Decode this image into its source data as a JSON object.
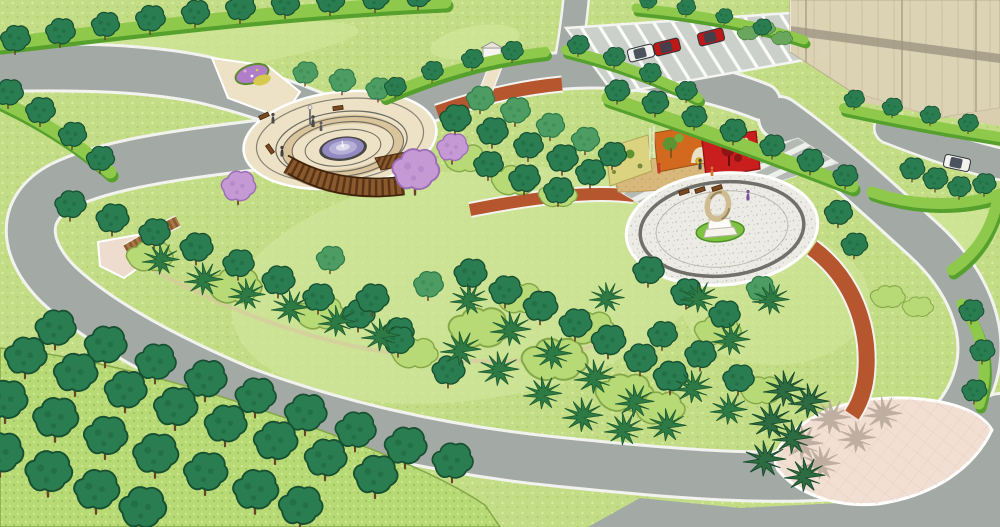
{
  "meta": {
    "title": "Park landscape design - aerial 3D rendering",
    "description": "SketchUp-style bird's-eye rendering of a public park with fountain plaza, pergola, sculpture plaza with colored art walls, leaf-shaped plaza, ring roads, street trees, parking lot with cars and a residential tower.",
    "view": "aerial isometric",
    "width": 1000,
    "height": 527
  },
  "features": {
    "fountain_plaza": "Circular fountain plaza with pergola",
    "sculpture_plaza": "Sculpture plaza with art walls",
    "leaf_plaza": "Leaf-shaped paved plaza",
    "parking_lot": "Roadside parking",
    "building": "Residential tower",
    "ring_road": "Perimeter ring road"
  },
  "palette": {
    "lawn": "#c3dc86",
    "lawnBright": "#cfe699",
    "road": "#a3aaa6",
    "roadEdge": "#f2f3ef",
    "hedge": "#8fc94c",
    "hedgeDark": "#56a02e",
    "treeDark": "#2a7d50",
    "treeDarkOutline": "#174f31",
    "treeMid": "#4c9c63",
    "treeMidOutline": "#2e7a47",
    "shrubLight": "#b7d976",
    "shrubOutline": "#84a847",
    "spikyGreen": "#2e7a44",
    "trunk": "#6b4226",
    "plazaCream": "#ede1c6",
    "ringTan": "#d9c49c",
    "ringLine": "#6b6b60",
    "poolRim": "#474743",
    "water": "#928ac1",
    "waterLight": "#b5afd6",
    "pergola": "#8a5a2e",
    "pergolaDark": "#5a3516",
    "purple": "#c59ad4",
    "purpleDark": "#9c6cb4",
    "brick": "#b5562f",
    "plazaWhite": "#edece4",
    "bedGreen": "#7fc341",
    "sculpt": "#cfbc92",
    "wallCream": "#dbd37f",
    "wallOrange": "#d2691e",
    "wallRed": "#c81e1e",
    "sand": "#d9b87c",
    "building": "#ddd3b6",
    "buildingLine": "#c6ba9c",
    "parking": "#cbd0ca",
    "pinkPlaza": "#f2dfd3",
    "wood": "#a87848",
    "carGlass": "#39424e",
    "carRed": "#bf1817",
    "carWhite": "#f2f2ef"
  },
  "vegetation": {
    "street_tree_rows": [
      {
        "trees": [
          [
            15,
            40,
            0.95
          ],
          [
            60,
            33,
            0.95
          ],
          [
            105,
            26,
            0.9
          ],
          [
            150,
            20,
            0.95
          ],
          [
            195,
            14,
            0.9
          ],
          [
            240,
            9,
            0.95
          ],
          [
            285,
            5,
            0.9
          ],
          [
            330,
            2,
            0.9
          ],
          [
            375,
            -1,
            0.9
          ],
          [
            418,
            -3,
            0.85
          ]
        ]
      },
      {
        "trees": [
          [
            8,
            94,
            0.95
          ],
          [
            40,
            112,
            0.95
          ],
          [
            72,
            136,
            0.9
          ],
          [
            100,
            160,
            0.9
          ]
        ]
      },
      {
        "trees": [
          [
            395,
            88,
            0.7
          ],
          [
            432,
            72,
            0.7
          ],
          [
            472,
            60,
            0.7
          ],
          [
            512,
            52,
            0.7
          ]
        ]
      },
      {
        "trees": [
          [
            578,
            46,
            0.7
          ],
          [
            614,
            58,
            0.7
          ],
          [
            650,
            74,
            0.7
          ],
          [
            686,
            92,
            0.7
          ]
        ]
      },
      {
        "trees": [
          [
            617,
            92,
            0.8
          ],
          [
            655,
            104,
            0.85
          ],
          [
            694,
            118,
            0.8
          ],
          [
            733,
            132,
            0.85
          ],
          [
            772,
            147,
            0.8
          ],
          [
            810,
            162,
            0.85
          ],
          [
            845,
            177,
            0.8
          ]
        ]
      },
      {
        "trees": [
          [
            648,
            2,
            0.55
          ],
          [
            686,
            8,
            0.6
          ],
          [
            724,
            17,
            0.55
          ],
          [
            762,
            28,
            0.6
          ]
        ]
      },
      {
        "trees": [
          [
            854,
            100,
            0.65
          ],
          [
            892,
            108,
            0.65
          ],
          [
            930,
            116,
            0.65
          ],
          [
            968,
            124,
            0.65
          ]
        ]
      },
      {
        "trees": [
          [
            912,
            170,
            0.8
          ],
          [
            935,
            180,
            0.8
          ],
          [
            959,
            188,
            0.75
          ],
          [
            984,
            185,
            0.75
          ]
        ]
      },
      {
        "trees": [
          [
            971,
            312,
            0.8
          ],
          [
            982,
            352,
            0.8
          ],
          [
            974,
            392,
            0.8
          ]
        ]
      }
    ],
    "grove_trees": [
      [
        305,
        74,
        0.8,
        "m"
      ],
      [
        342,
        82,
        0.85,
        "m"
      ],
      [
        378,
        90,
        0.8,
        "m"
      ],
      [
        480,
        100,
        0.9,
        "m"
      ],
      [
        515,
        112,
        0.95,
        "m"
      ],
      [
        550,
        127,
        0.9,
        "m"
      ],
      [
        585,
        141,
        0.9,
        "m"
      ],
      [
        455,
        120,
        1
      ],
      [
        492,
        133,
        1
      ],
      [
        528,
        147,
        0.95
      ],
      [
        562,
        160,
        1
      ],
      [
        590,
        174,
        0.95
      ],
      [
        612,
        156,
        0.9
      ],
      [
        488,
        166,
        0.95
      ],
      [
        524,
        180,
        1
      ],
      [
        558,
        192,
        0.95
      ],
      [
        838,
        214,
        0.9
      ],
      [
        854,
        246,
        0.85
      ],
      [
        70,
        206,
        1
      ],
      [
        112,
        220,
        1.05
      ],
      [
        154,
        234,
        1
      ],
      [
        196,
        249,
        1.05
      ],
      [
        238,
        265,
        1
      ],
      [
        278,
        282,
        1.05
      ],
      [
        318,
        299,
        1
      ],
      [
        358,
        316,
        1.05
      ],
      [
        398,
        333,
        1
      ],
      [
        330,
        260,
        0.9,
        "m"
      ],
      [
        428,
        286,
        0.95,
        "m"
      ],
      [
        372,
        300,
        1.05
      ],
      [
        398,
        342,
        1
      ],
      [
        448,
        372,
        1.05
      ],
      [
        470,
        275,
        1.05
      ],
      [
        505,
        292,
        1.05
      ],
      [
        540,
        308,
        1.1
      ],
      [
        575,
        325,
        1.05
      ],
      [
        608,
        342,
        1.1
      ],
      [
        640,
        360,
        1.05
      ],
      [
        670,
        378,
        1.1
      ],
      [
        760,
        290,
        0.9,
        "m"
      ],
      [
        648,
        272,
        1
      ],
      [
        686,
        294,
        1
      ],
      [
        724,
        316,
        1
      ],
      [
        662,
        336,
        0.95
      ],
      [
        700,
        356,
        1
      ],
      [
        738,
        380,
        1
      ],
      [
        55,
        330,
        1.3
      ],
      [
        105,
        347,
        1.35
      ],
      [
        155,
        364,
        1.3
      ],
      [
        205,
        381,
        1.35
      ],
      [
        255,
        398,
        1.3
      ],
      [
        305,
        415,
        1.35
      ],
      [
        355,
        432,
        1.3
      ],
      [
        405,
        448,
        1.35
      ],
      [
        452,
        463,
        1.3
      ],
      [
        25,
        358,
        1.35
      ],
      [
        75,
        375,
        1.4
      ],
      [
        125,
        392,
        1.35
      ],
      [
        175,
        409,
        1.4
      ],
      [
        225,
        426,
        1.35
      ],
      [
        275,
        443,
        1.4
      ],
      [
        325,
        460,
        1.35
      ],
      [
        375,
        477,
        1.4
      ],
      [
        5,
        402,
        1.4
      ],
      [
        55,
        420,
        1.45
      ],
      [
        105,
        438,
        1.4
      ],
      [
        155,
        456,
        1.45
      ],
      [
        205,
        474,
        1.4
      ],
      [
        255,
        492,
        1.45
      ],
      [
        300,
        508,
        1.4
      ],
      [
        0,
        455,
        1.45
      ],
      [
        48,
        474,
        1.5
      ],
      [
        96,
        492,
        1.45
      ],
      [
        142,
        510,
        1.5
      ]
    ],
    "shrub_masses": [
      [
        150,
        258,
        1.2
      ],
      [
        235,
        288,
        1.4
      ],
      [
        320,
        315,
        1.3
      ],
      [
        415,
        355,
        1.2
      ],
      [
        480,
        330,
        1.6
      ],
      [
        555,
        362,
        1.7
      ],
      [
        625,
        395,
        1.5
      ],
      [
        520,
        300,
        1.2
      ],
      [
        590,
        330,
        1.3
      ],
      [
        660,
        410,
        1.3
      ],
      [
        465,
        160,
        1.1
      ],
      [
        515,
        182,
        1.2
      ],
      [
        558,
        196,
        1
      ],
      [
        718,
        332,
        1.2
      ],
      [
        762,
        392,
        1.1
      ],
      [
        888,
        298,
        0.9
      ],
      [
        918,
        308,
        0.8
      ],
      [
        748,
        34,
        0.55,
        "g"
      ],
      [
        766,
        29,
        0.5,
        "g"
      ],
      [
        782,
        39,
        0.55,
        "g"
      ]
    ],
    "spiky_shrubs": [
      [
        162,
        262,
        1
      ],
      [
        205,
        282,
        1.05
      ],
      [
        248,
        297,
        1
      ],
      [
        292,
        310,
        1.05
      ],
      [
        338,
        324,
        1
      ],
      [
        382,
        338,
        1.05
      ],
      [
        462,
        352,
        1.1
      ],
      [
        470,
        302,
        1
      ],
      [
        512,
        332,
        1.1
      ],
      [
        554,
        356,
        1.05
      ],
      [
        596,
        380,
        1.1
      ],
      [
        636,
        404,
        1.05
      ],
      [
        500,
        372,
        1.1
      ],
      [
        544,
        396,
        1.05
      ],
      [
        584,
        418,
        1.1
      ],
      [
        625,
        432,
        1.05
      ],
      [
        700,
        300,
        1
      ],
      [
        732,
        342,
        1.05
      ],
      [
        772,
        302,
        1
      ],
      [
        694,
        390,
        1.05
      ],
      [
        730,
        412,
        1
      ],
      [
        668,
        428,
        1.05
      ],
      [
        608,
        300,
        0.95
      ]
    ],
    "dark_palms": [
      [
        786,
        392,
        1.15
      ],
      [
        810,
        404,
        1.1
      ],
      [
        772,
        424,
        1.15
      ],
      [
        794,
        440,
        1.1
      ],
      [
        766,
        462,
        1.15
      ],
      [
        806,
        478,
        1.1
      ]
    ],
    "palm_shadows": [
      [
        832,
        420,
        1.1
      ],
      [
        884,
        416,
        1.05
      ],
      [
        804,
        446,
        1.1
      ],
      [
        822,
        466,
        1.05
      ],
      [
        858,
        440,
        1
      ]
    ],
    "purple_trees": [
      [
        238,
        188,
        1.1
      ],
      [
        415,
        172,
        1.5
      ],
      [
        452,
        149,
        1
      ]
    ]
  },
  "objects": {
    "cars": [
      {
        "x": 641,
        "y": 53,
        "angle": -14,
        "color": "#f2f2ef",
        "label": "white van"
      },
      {
        "x": 667,
        "y": 47,
        "angle": -14,
        "color": "#bf1817",
        "label": "red car"
      },
      {
        "x": 711,
        "y": 37,
        "angle": -14,
        "color": "#bf1817",
        "label": "red car"
      },
      {
        "x": 957,
        "y": 163,
        "angle": 12,
        "color": "#f2f2ef",
        "label": "white car"
      }
    ],
    "people": [
      {
        "x": 313,
        "y": 122,
        "c": "#4a4a4a",
        "s": 1
      },
      {
        "x": 321,
        "y": 127,
        "c": "#5a5a5a",
        "s": 0.8
      },
      {
        "x": 273,
        "y": 119,
        "c": "#4a4a4a",
        "s": 0.9
      },
      {
        "x": 282,
        "y": 152,
        "c": "#3f3f3f",
        "s": 0.9
      },
      {
        "x": 659,
        "y": 169,
        "c": "#c23b2a",
        "s": 0.9
      },
      {
        "x": 700,
        "y": 165,
        "c": "#444444",
        "s": 0.9
      },
      {
        "x": 712,
        "y": 172,
        "c": "#d07830",
        "s": 0.8
      },
      {
        "x": 748,
        "y": 196,
        "c": "#7a4fa0",
        "s": 0.9
      }
    ],
    "benches": [
      [
        264,
        116,
        -25
      ],
      [
        270,
        149,
        55
      ],
      [
        338,
        108,
        -8
      ],
      [
        700,
        190,
        -18
      ],
      [
        717,
        188,
        -18
      ],
      [
        684,
        192,
        -18
      ]
    ]
  }
}
